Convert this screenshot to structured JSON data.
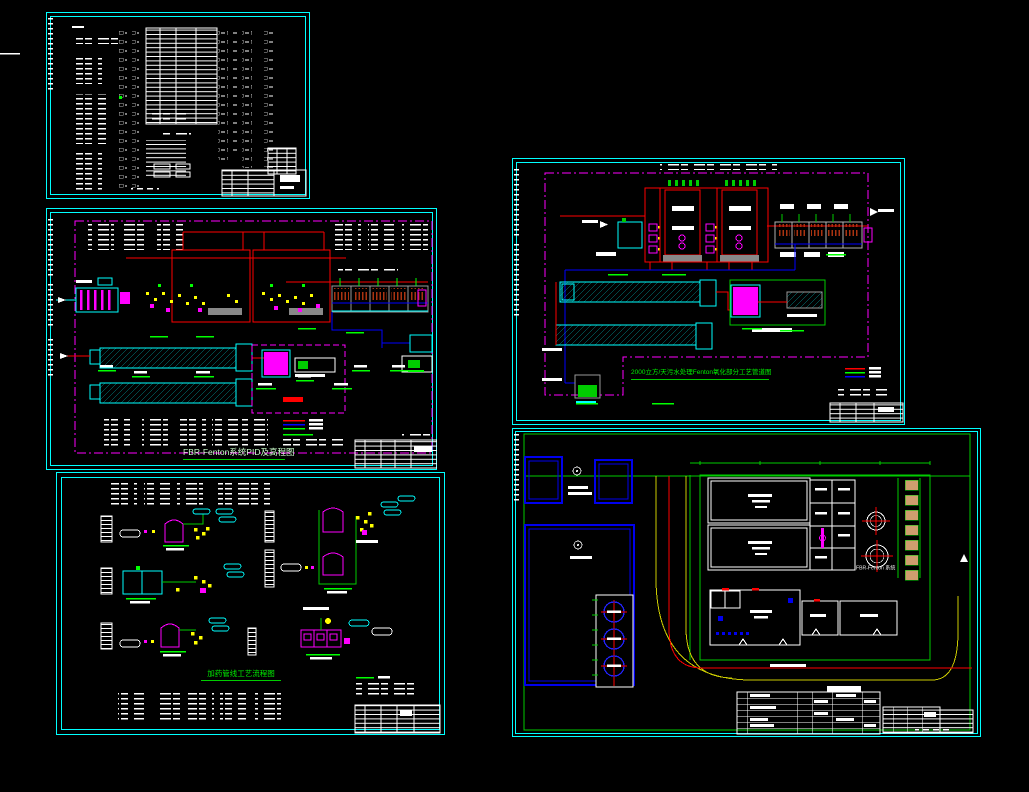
{
  "canvas": {
    "background": "#000000",
    "width": 1029,
    "height": 792
  },
  "palette": {
    "sheet_border": "#00ffff",
    "frame_magenta": "#ff00ff",
    "pipe_red": "#ff0000",
    "pipe_blue": "#0000ff",
    "annotation_green": "#00ff00",
    "valve_yellow": "#ffff00",
    "text_white": "#ffffff",
    "equipment_gray": "#9a9a9a",
    "parking_tan": "#cf9e6e"
  },
  "sheets": {
    "pid": {
      "title": "FBR-Fenton系统PID及高程图"
    },
    "dosing": {
      "title": "加药管线工艺流程图"
    },
    "fenton_process": {
      "title": "2000立方/天污水处理Fenton氧化部分工艺管道图"
    },
    "site_plan": {
      "fbr_label": "FBR-Fenton 系统"
    }
  },
  "legends": {
    "pid_line_colors": [
      "#ff0000",
      "#0000ff",
      "#00ff00"
    ],
    "fenton_line_colors": [
      "#ff0000",
      "#00ff00",
      "#0000ff"
    ]
  }
}
